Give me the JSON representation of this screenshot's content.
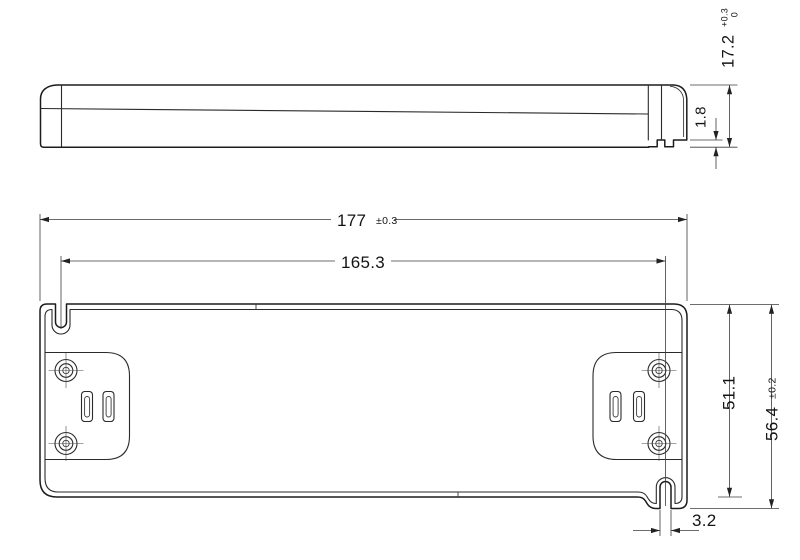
{
  "drawing": {
    "colors": {
      "line": "#1c1c1c",
      "background": "#ffffff"
    },
    "dimensions": {
      "overall_length": {
        "value": "177",
        "tolerance": "±0.3"
      },
      "mounting_slot_spacing": {
        "value": "165.3"
      },
      "case_height": {
        "value": "17.2",
        "tolerance_upper": "+0.3",
        "tolerance_lower": "0"
      },
      "foot_standoff": {
        "value": "1.8"
      },
      "body_width": {
        "value": "51.1"
      },
      "overall_width": {
        "value": "56.4",
        "tolerance": "±0.2"
      },
      "mounting_slot_width": {
        "value": "3.2"
      }
    }
  }
}
